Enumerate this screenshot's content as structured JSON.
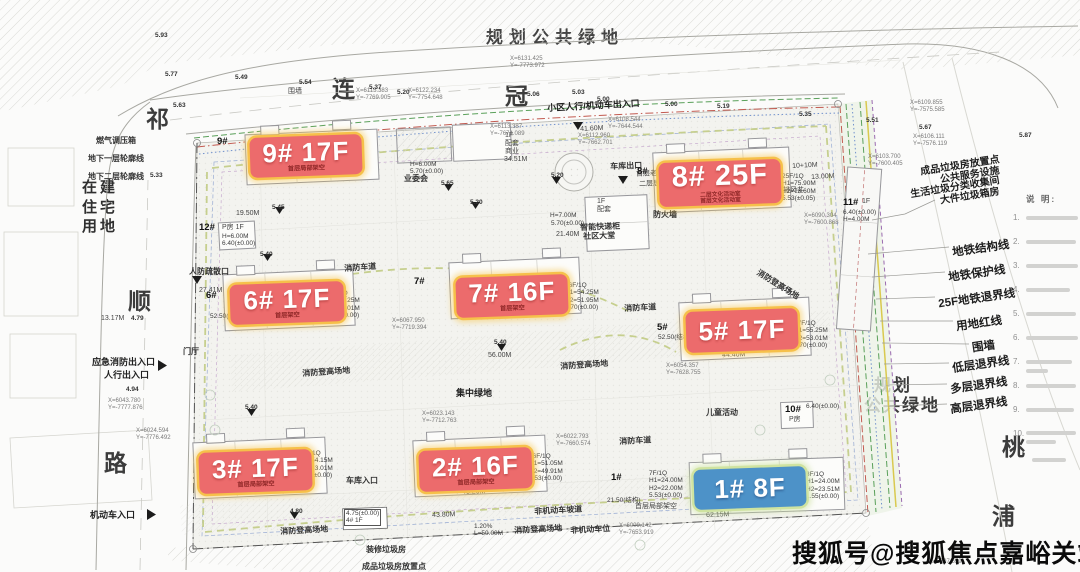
{
  "roads": {
    "top": [
      "连",
      "冠",
      "路"
    ],
    "left": [
      "祁",
      "顺",
      "路"
    ],
    "river": [
      "桃",
      "浦"
    ]
  },
  "areas": {
    "top": "规划公共绿地",
    "right1": "规划",
    "right2": "公共绿地",
    "west": "在建\n住宅\n用地"
  },
  "buildings": {
    "b9": {
      "label": "9# 17F",
      "sub": "首层局部架空"
    },
    "b8": {
      "label": "8# 25F",
      "sub": "二层文化活动室\n首层文化活动室"
    },
    "b7": {
      "label": "7# 16F",
      "sub": "首层架空"
    },
    "b6": {
      "label": "6# 17F",
      "sub": "首层架空"
    },
    "b5": {
      "label": "5# 17F",
      "sub": ""
    },
    "b3": {
      "label": "3# 17F",
      "sub": "首层局部架空"
    },
    "b2": {
      "label": "2# 16F",
      "sub": "首层局部架空"
    },
    "b1": {
      "label": "1# 8F"
    }
  },
  "legend": {
    "items": [
      "地铁结构线",
      "地铁保护线",
      "25F地铁退界线",
      "用地红线",
      "围墙",
      "低层退界线",
      "多层退界线",
      "高层退界线"
    ]
  },
  "waste": {
    "lines": [
      "成品垃圾房放置点",
      "公共服务设施",
      "生活垃圾分类收集间",
      "大件垃圾箱房"
    ]
  },
  "notes": {
    "header": "说 明:",
    "numbers": [
      "1.",
      "2.",
      "3.",
      "4.",
      "5.",
      "6.",
      "7.",
      "8.",
      "9.",
      "10."
    ]
  },
  "watermark": "搜狐号@搜狐焦点嘉峪关站",
  "annotations": [
    {
      "id": "gas-box",
      "text": "燃气调压箱",
      "x": 96,
      "y": 136,
      "cls": "a7"
    },
    {
      "id": "underground-l1",
      "text": "地下一层轮廓线",
      "x": 88,
      "y": 154,
      "cls": "a7"
    },
    {
      "id": "underground-l2",
      "text": "地下二层轮廓线",
      "x": 88,
      "y": 172,
      "cls": "a7"
    },
    {
      "id": "wall-top",
      "text": "围墙",
      "x": 288,
      "y": 88,
      "cls": "a6"
    },
    {
      "id": "entry-top",
      "text": "小区人行/机动车出入口",
      "x": 547,
      "y": 103,
      "cls": "a8",
      "rot": -3
    },
    {
      "id": "garage-exit",
      "text": "车库出口",
      "x": 610,
      "y": 162,
      "cls": "a7",
      "rot": -2
    },
    {
      "id": "owners-committee",
      "text": "业委会",
      "x": 404,
      "y": 174,
      "cls": "a7"
    },
    {
      "id": "podium-retail",
      "text": "1F\n配套\n商业",
      "x": 505,
      "y": 132,
      "cls": "a6"
    },
    {
      "id": "podium-h6",
      "text": "H=6.00M\n5.70(±0.00)",
      "x": 410,
      "y": 161,
      "cls": "spec"
    },
    {
      "id": "smart-locker",
      "text": "智能快递柜",
      "x": 580,
      "y": 223,
      "cls": "a7",
      "rot": -2
    },
    {
      "id": "community-lobby",
      "text": "社区大堂",
      "x": 583,
      "y": 232,
      "cls": "a7",
      "rot": -2
    },
    {
      "id": "podium-1f",
      "text": "1F\n配套",
      "x": 597,
      "y": 198,
      "cls": "a6"
    },
    {
      "id": "firewall",
      "text": "防火墙",
      "x": 653,
      "y": 210,
      "cls": "a7"
    },
    {
      "id": "elder-room",
      "text": "首层老年活动室",
      "x": 636,
      "y": 171,
      "cls": "a6",
      "rot": -2
    },
    {
      "id": "juwei-room",
      "text": "二层居委会",
      "x": 639,
      "y": 181,
      "cls": "a6",
      "rot": -2
    },
    {
      "id": "svc-h7",
      "text": "H=7.00M",
      "x": 550,
      "y": 212,
      "cls": "spec"
    },
    {
      "id": "svc-570",
      "text": "5.70(±0.00)",
      "x": 551,
      "y": 220,
      "cls": "spec"
    },
    {
      "id": "num-12",
      "text": "12#",
      "x": 199,
      "y": 223,
      "cls": "bnum"
    },
    {
      "id": "p-room-12",
      "text": "P房 1F",
      "x": 222,
      "y": 224,
      "cls": "a6"
    },
    {
      "id": "spec-12",
      "text": "H=6.00M\n6.40(±0.00)",
      "x": 222,
      "y": 233,
      "cls": "spec"
    },
    {
      "id": "renfang-exit",
      "text": "人防疏散口",
      "x": 189,
      "y": 267,
      "cls": "a7"
    },
    {
      "id": "lobby-hall",
      "text": "门厅",
      "x": 183,
      "y": 347,
      "cls": "a7"
    },
    {
      "id": "emergency-exit",
      "text": "应急消防出入口",
      "x": 92,
      "y": 357,
      "cls": "a8"
    },
    {
      "id": "ped-exit",
      "text": "人行出入口",
      "x": 104,
      "y": 370,
      "cls": "a8"
    },
    {
      "id": "motor-entry",
      "text": "机动车入口",
      "x": 90,
      "y": 510,
      "cls": "a8"
    },
    {
      "id": "garage-entry",
      "text": "车库入口",
      "x": 346,
      "y": 476,
      "cls": "a7"
    },
    {
      "id": "firelane-1",
      "text": "消防车道",
      "x": 344,
      "y": 264,
      "cls": "a7",
      "rot": -4
    },
    {
      "id": "firelane-2",
      "text": "消防车道",
      "x": 624,
      "y": 304,
      "cls": "a7",
      "rot": -3
    },
    {
      "id": "firelane-3",
      "text": "消防车道",
      "x": 619,
      "y": 437,
      "cls": "a7",
      "rot": -3
    },
    {
      "id": "hoist-1",
      "text": "消防登高场地",
      "x": 302,
      "y": 369,
      "cls": "a7",
      "rot": -4
    },
    {
      "id": "hoist-2",
      "text": "消防登高场地",
      "x": 560,
      "y": 362,
      "cls": "a7",
      "rot": -4
    },
    {
      "id": "hoist-3",
      "text": "消防登高场地",
      "x": 280,
      "y": 527,
      "cls": "a7",
      "rot": -3
    },
    {
      "id": "hoist-4",
      "text": "消防登高场地",
      "x": 514,
      "y": 526,
      "cls": "a7",
      "rot": -3
    },
    {
      "id": "hoist-5",
      "text": "消防登高场地",
      "x": 760,
      "y": 268,
      "cls": "a7",
      "rot": 32
    },
    {
      "id": "central-green",
      "text": "集中绿地",
      "x": 456,
      "y": 388,
      "cls": "a8"
    },
    {
      "id": "children-play",
      "text": "儿童活动",
      "x": 706,
      "y": 408,
      "cls": "a7"
    },
    {
      "id": "nonmotor-ramp",
      "text": "非机动车坡道",
      "x": 534,
      "y": 507,
      "cls": "a7",
      "rot": -3
    },
    {
      "id": "nonmotor-park",
      "text": "非机动车位",
      "x": 570,
      "y": 526,
      "cls": "a7",
      "rot": -3
    },
    {
      "id": "deco-waste",
      "text": "装修垃圾房",
      "x": 366,
      "y": 545,
      "cls": "a7"
    },
    {
      "id": "waste-bottom",
      "text": "成品垃圾房放置点",
      "x": 362,
      "y": 562,
      "cls": "a7"
    },
    {
      "id": "struct-2150",
      "text": "21.50(结构)",
      "x": 607,
      "y": 497,
      "cls": "spec"
    },
    {
      "id": "arch-1f",
      "text": "首层局部架空",
      "x": 635,
      "y": 503,
      "cls": "a6"
    },
    {
      "id": "num-9",
      "text": "9#",
      "x": 217,
      "y": 137,
      "cls": "bnum"
    },
    {
      "id": "num-8",
      "text": "8#",
      "x": 637,
      "y": 167,
      "cls": "bnum"
    },
    {
      "id": "num-7",
      "text": "7#",
      "x": 414,
      "y": 277,
      "cls": "bnum"
    },
    {
      "id": "num-6",
      "text": "6#",
      "x": 206,
      "y": 291,
      "cls": "bnum"
    },
    {
      "id": "num-5",
      "text": "5#",
      "x": 657,
      "y": 323,
      "cls": "bnum"
    },
    {
      "id": "num-2",
      "text": "2#",
      "x": 431,
      "y": 448,
      "cls": "bnum"
    },
    {
      "id": "num-1",
      "text": "1#",
      "x": 611,
      "y": 473,
      "cls": "bnum"
    },
    {
      "id": "num-4",
      "text": "4.75(±0.00)\n4# 1F",
      "x": 344,
      "y": 509,
      "cls": "specbox"
    },
    {
      "id": "num-10",
      "text": "10#",
      "x": 785,
      "y": 405,
      "cls": "bnum"
    },
    {
      "id": "spec-10",
      "text": "6.40(±0.00)",
      "x": 806,
      "y": 403,
      "cls": "spec"
    },
    {
      "id": "p-room-10",
      "text": "P房",
      "x": 789,
      "y": 416,
      "cls": "a6"
    },
    {
      "id": "num-11",
      "text": "11#",
      "x": 843,
      "y": 198,
      "cls": "bnum"
    },
    {
      "id": "num-11-1f",
      "text": "1F",
      "x": 862,
      "y": 198,
      "cls": "a6"
    },
    {
      "id": "spec-11",
      "text": "6.40(±0.00)\nH=4.00M",
      "x": 843,
      "y": 209,
      "cls": "spec"
    },
    {
      "id": "vent-shaft",
      "text": "排风井",
      "x": 783,
      "y": 187,
      "cls": "a6"
    },
    {
      "id": "dim-1010",
      "text": "10+10M",
      "x": 792,
      "y": 163,
      "cls": "a6",
      "rot": -3
    },
    {
      "id": "dim-13",
      "text": "13.00M",
      "x": 811,
      "y": 174,
      "cls": "a6",
      "rot": -3
    },
    {
      "id": "spec-b1",
      "text": "8F/1Q\nH1=24.00M\nH2=23.51M\n1.55(±0.00)",
      "x": 806,
      "y": 471,
      "cls": "spec"
    },
    {
      "id": "spec-b1w",
      "text": "7F/1Q\nH1=24.00M\nH2=22.00M\n5.53(±0.00)",
      "x": 649,
      "y": 470,
      "cls": "spec"
    },
    {
      "id": "spec-b5",
      "text": "17F/1Q\nH1=55.25M\nH2=53.01M\n5.70(±0.00)",
      "x": 794,
      "y": 320,
      "cls": "spec"
    },
    {
      "id": "spec-b7",
      "text": "16F/1Q\nH1=54.25M\nH2=51.95M\n5.70(±0.00)",
      "x": 565,
      "y": 282,
      "cls": "spec"
    },
    {
      "id": "spec-b6",
      "text": "17F/1Q\nH1=55.25M\nH2=53.01M\n5.55(±0.00)",
      "x": 326,
      "y": 290,
      "cls": "spec"
    },
    {
      "id": "spec-b3",
      "text": "17F/1Q\nH1=54.15M\nH2=53.01M\n5.53(±0.00)",
      "x": 299,
      "y": 450,
      "cls": "spec"
    },
    {
      "id": "spec-b2",
      "text": "16F/1Q\nH1=51.05M\nH2=49.91M\n5.53(±0.00)",
      "x": 529,
      "y": 453,
      "cls": "spec"
    },
    {
      "id": "spec-b8",
      "text": "25F/1Q\nH1=75.90M\nH2=73.60M\n5.53(±0.05)",
      "x": 782,
      "y": 173,
      "cls": "spec"
    },
    {
      "id": "struct-b5",
      "text": "52.50(结构)",
      "x": 658,
      "y": 334,
      "cls": "spec"
    },
    {
      "id": "struct-b6",
      "text": "52.50(结构)",
      "x": 210,
      "y": 313,
      "cls": "spec"
    },
    {
      "id": "coord-1",
      "text": "X=6131.425\nY=-7773.972",
      "x": 510,
      "y": 56,
      "cls": "coord"
    },
    {
      "id": "coord-2",
      "text": "X=6115.383\nY=-7769.905",
      "x": 356,
      "y": 88,
      "cls": "coord"
    },
    {
      "id": "coord-3",
      "text": "X=6122.234\nY=-7754.648",
      "x": 408,
      "y": 88,
      "cls": "coord"
    },
    {
      "id": "coord-4",
      "text": "X=6113.387\nY=-7674.089",
      "x": 490,
      "y": 124,
      "cls": "coord"
    },
    {
      "id": "coord-5",
      "text": "X=6112.960\nY=-7662.701",
      "x": 578,
      "y": 133,
      "cls": "coord"
    },
    {
      "id": "coord-6",
      "text": "X=6108.544\nY=-7644.544",
      "x": 608,
      "y": 117,
      "cls": "coord"
    },
    {
      "id": "coord-7",
      "text": "X=6109.855\nY=-7575.585",
      "x": 910,
      "y": 100,
      "cls": "coord"
    },
    {
      "id": "coord-8",
      "text": "X=6106.111\nY=-7576.119",
      "x": 913,
      "y": 134,
      "cls": "coord"
    },
    {
      "id": "coord-9",
      "text": "X=6103.700\nY=-7600.405",
      "x": 868,
      "y": 154,
      "cls": "coord"
    },
    {
      "id": "coord-10",
      "text": "X=6090.304\nY=-7600.868",
      "x": 804,
      "y": 213,
      "cls": "coord"
    },
    {
      "id": "coord-11",
      "text": "X=6043.780\nY=-7777.876",
      "x": 108,
      "y": 398,
      "cls": "coord"
    },
    {
      "id": "coord-12",
      "text": "X=6024.594\nY=-7776.492",
      "x": 136,
      "y": 428,
      "cls": "coord"
    },
    {
      "id": "coord-13",
      "text": "X=6023.143\nY=-7712.763",
      "x": 422,
      "y": 411,
      "cls": "coord"
    },
    {
      "id": "coord-14",
      "text": "X=6022.793\nY=-7660.574",
      "x": 556,
      "y": 434,
      "cls": "coord"
    },
    {
      "id": "coord-15",
      "text": "X=6009.142\nY=-7653.919",
      "x": 619,
      "y": 523,
      "cls": "coord"
    },
    {
      "id": "coord-16",
      "text": "X=5897.659",
      "x": 929,
      "y": 559,
      "cls": "coord"
    },
    {
      "id": "coord-17",
      "text": "X=6067.950\nY=-7719.394",
      "x": 392,
      "y": 318,
      "cls": "coord"
    },
    {
      "id": "coord-18",
      "text": "X=6054.357\nY=-7628.755",
      "x": 666,
      "y": 363,
      "cls": "coord"
    },
    {
      "id": "elev-1",
      "text": "5.93",
      "x": 155,
      "y": 32,
      "cls": "elev"
    },
    {
      "id": "elev-2",
      "text": "5.77",
      "x": 165,
      "y": 71,
      "cls": "elev"
    },
    {
      "id": "elev-3",
      "text": "5.49",
      "x": 235,
      "y": 74,
      "cls": "elev"
    },
    {
      "id": "elev-4",
      "text": "5.54",
      "x": 299,
      "y": 79,
      "cls": "elev"
    },
    {
      "id": "elev-5",
      "text": "5.37",
      "x": 369,
      "y": 84,
      "cls": "elev"
    },
    {
      "id": "elev-6",
      "text": "5.20",
      "x": 397,
      "y": 89,
      "cls": "elev"
    },
    {
      "id": "elev-7",
      "text": "5.06",
      "x": 527,
      "y": 91,
      "cls": "elev"
    },
    {
      "id": "elev-8",
      "text": "5.03",
      "x": 572,
      "y": 89,
      "cls": "elev"
    },
    {
      "id": "elev-9",
      "text": "5.00",
      "x": 597,
      "y": 96,
      "cls": "elev"
    },
    {
      "id": "elev-10",
      "text": "5.00",
      "x": 665,
      "y": 101,
      "cls": "elev"
    },
    {
      "id": "elev-11",
      "text": "5.19",
      "x": 717,
      "y": 103,
      "cls": "elev"
    },
    {
      "id": "elev-12",
      "text": "5.35",
      "x": 799,
      "y": 111,
      "cls": "elev"
    },
    {
      "id": "elev-13",
      "text": "5.51",
      "x": 866,
      "y": 117,
      "cls": "elev"
    },
    {
      "id": "elev-14",
      "text": "5.67",
      "x": 919,
      "y": 124,
      "cls": "elev"
    },
    {
      "id": "elev-15",
      "text": "5.87",
      "x": 1019,
      "y": 132,
      "cls": "elev"
    },
    {
      "id": "elev-16",
      "text": "5.63",
      "x": 173,
      "y": 102,
      "cls": "elev"
    },
    {
      "id": "elev-17",
      "text": "5.33",
      "x": 150,
      "y": 172,
      "cls": "elev"
    },
    {
      "id": "elev-18",
      "text": "5.20",
      "x": 551,
      "y": 172,
      "cls": "elev"
    },
    {
      "id": "elev-19",
      "text": "5.65",
      "x": 441,
      "y": 180,
      "cls": "elev"
    },
    {
      "id": "elev-20",
      "text": "5.20",
      "x": 470,
      "y": 199,
      "cls": "elev"
    },
    {
      "id": "elev-21",
      "text": "5.45",
      "x": 272,
      "y": 204,
      "cls": "elev"
    },
    {
      "id": "elev-22",
      "text": "5.40",
      "x": 260,
      "y": 251,
      "cls": "elev"
    },
    {
      "id": "elev-23",
      "text": "5.40",
      "x": 245,
      "y": 404,
      "cls": "elev"
    },
    {
      "id": "elev-24",
      "text": "5.40",
      "x": 494,
      "y": 339,
      "cls": "elev"
    },
    {
      "id": "elev-25",
      "text": "4.94",
      "x": 126,
      "y": 386,
      "cls": "elev"
    },
    {
      "id": "elev-26",
      "text": "4.79",
      "x": 131,
      "y": 315,
      "cls": "elev"
    },
    {
      "id": "elev-27",
      "text": "4.80",
      "x": 290,
      "y": 508,
      "cls": "elev"
    },
    {
      "id": "dim-4160",
      "text": "41.60M",
      "x": 580,
      "y": 126,
      "cls": "a6",
      "rot": -3
    },
    {
      "id": "dim-3451",
      "text": "34.51M",
      "x": 504,
      "y": 156,
      "cls": "a6"
    },
    {
      "id": "dim-2140",
      "text": "21.40M",
      "x": 556,
      "y": 231,
      "cls": "a6"
    },
    {
      "id": "dim-1950",
      "text": "19.50M",
      "x": 236,
      "y": 210,
      "cls": "a6"
    },
    {
      "id": "dim-2741",
      "text": "27.41M",
      "x": 199,
      "y": 287,
      "cls": "a6"
    },
    {
      "id": "dim-1317",
      "text": "13.17M",
      "x": 101,
      "y": 315,
      "cls": "a6"
    },
    {
      "id": "dim-4320",
      "text": "43.20M",
      "x": 462,
      "y": 489,
      "cls": "a6",
      "rot": -2
    },
    {
      "id": "dim-4380",
      "text": "43.80M",
      "x": 432,
      "y": 512,
      "cls": "a6",
      "rot": -2
    },
    {
      "id": "dim-ramp",
      "text": "1.20%\nL=50.00M",
      "x": 474,
      "y": 523,
      "cls": "spec"
    },
    {
      "id": "dim-6215",
      "text": "62.15M",
      "x": 706,
      "y": 512,
      "cls": "a6",
      "rot": -2
    },
    {
      "id": "dim-4440",
      "text": "44.40M",
      "x": 722,
      "y": 352,
      "cls": "a6",
      "rot": -2
    },
    {
      "id": "dim-5600",
      "text": "56.00M",
      "x": 488,
      "y": 352,
      "cls": "a6"
    }
  ]
}
